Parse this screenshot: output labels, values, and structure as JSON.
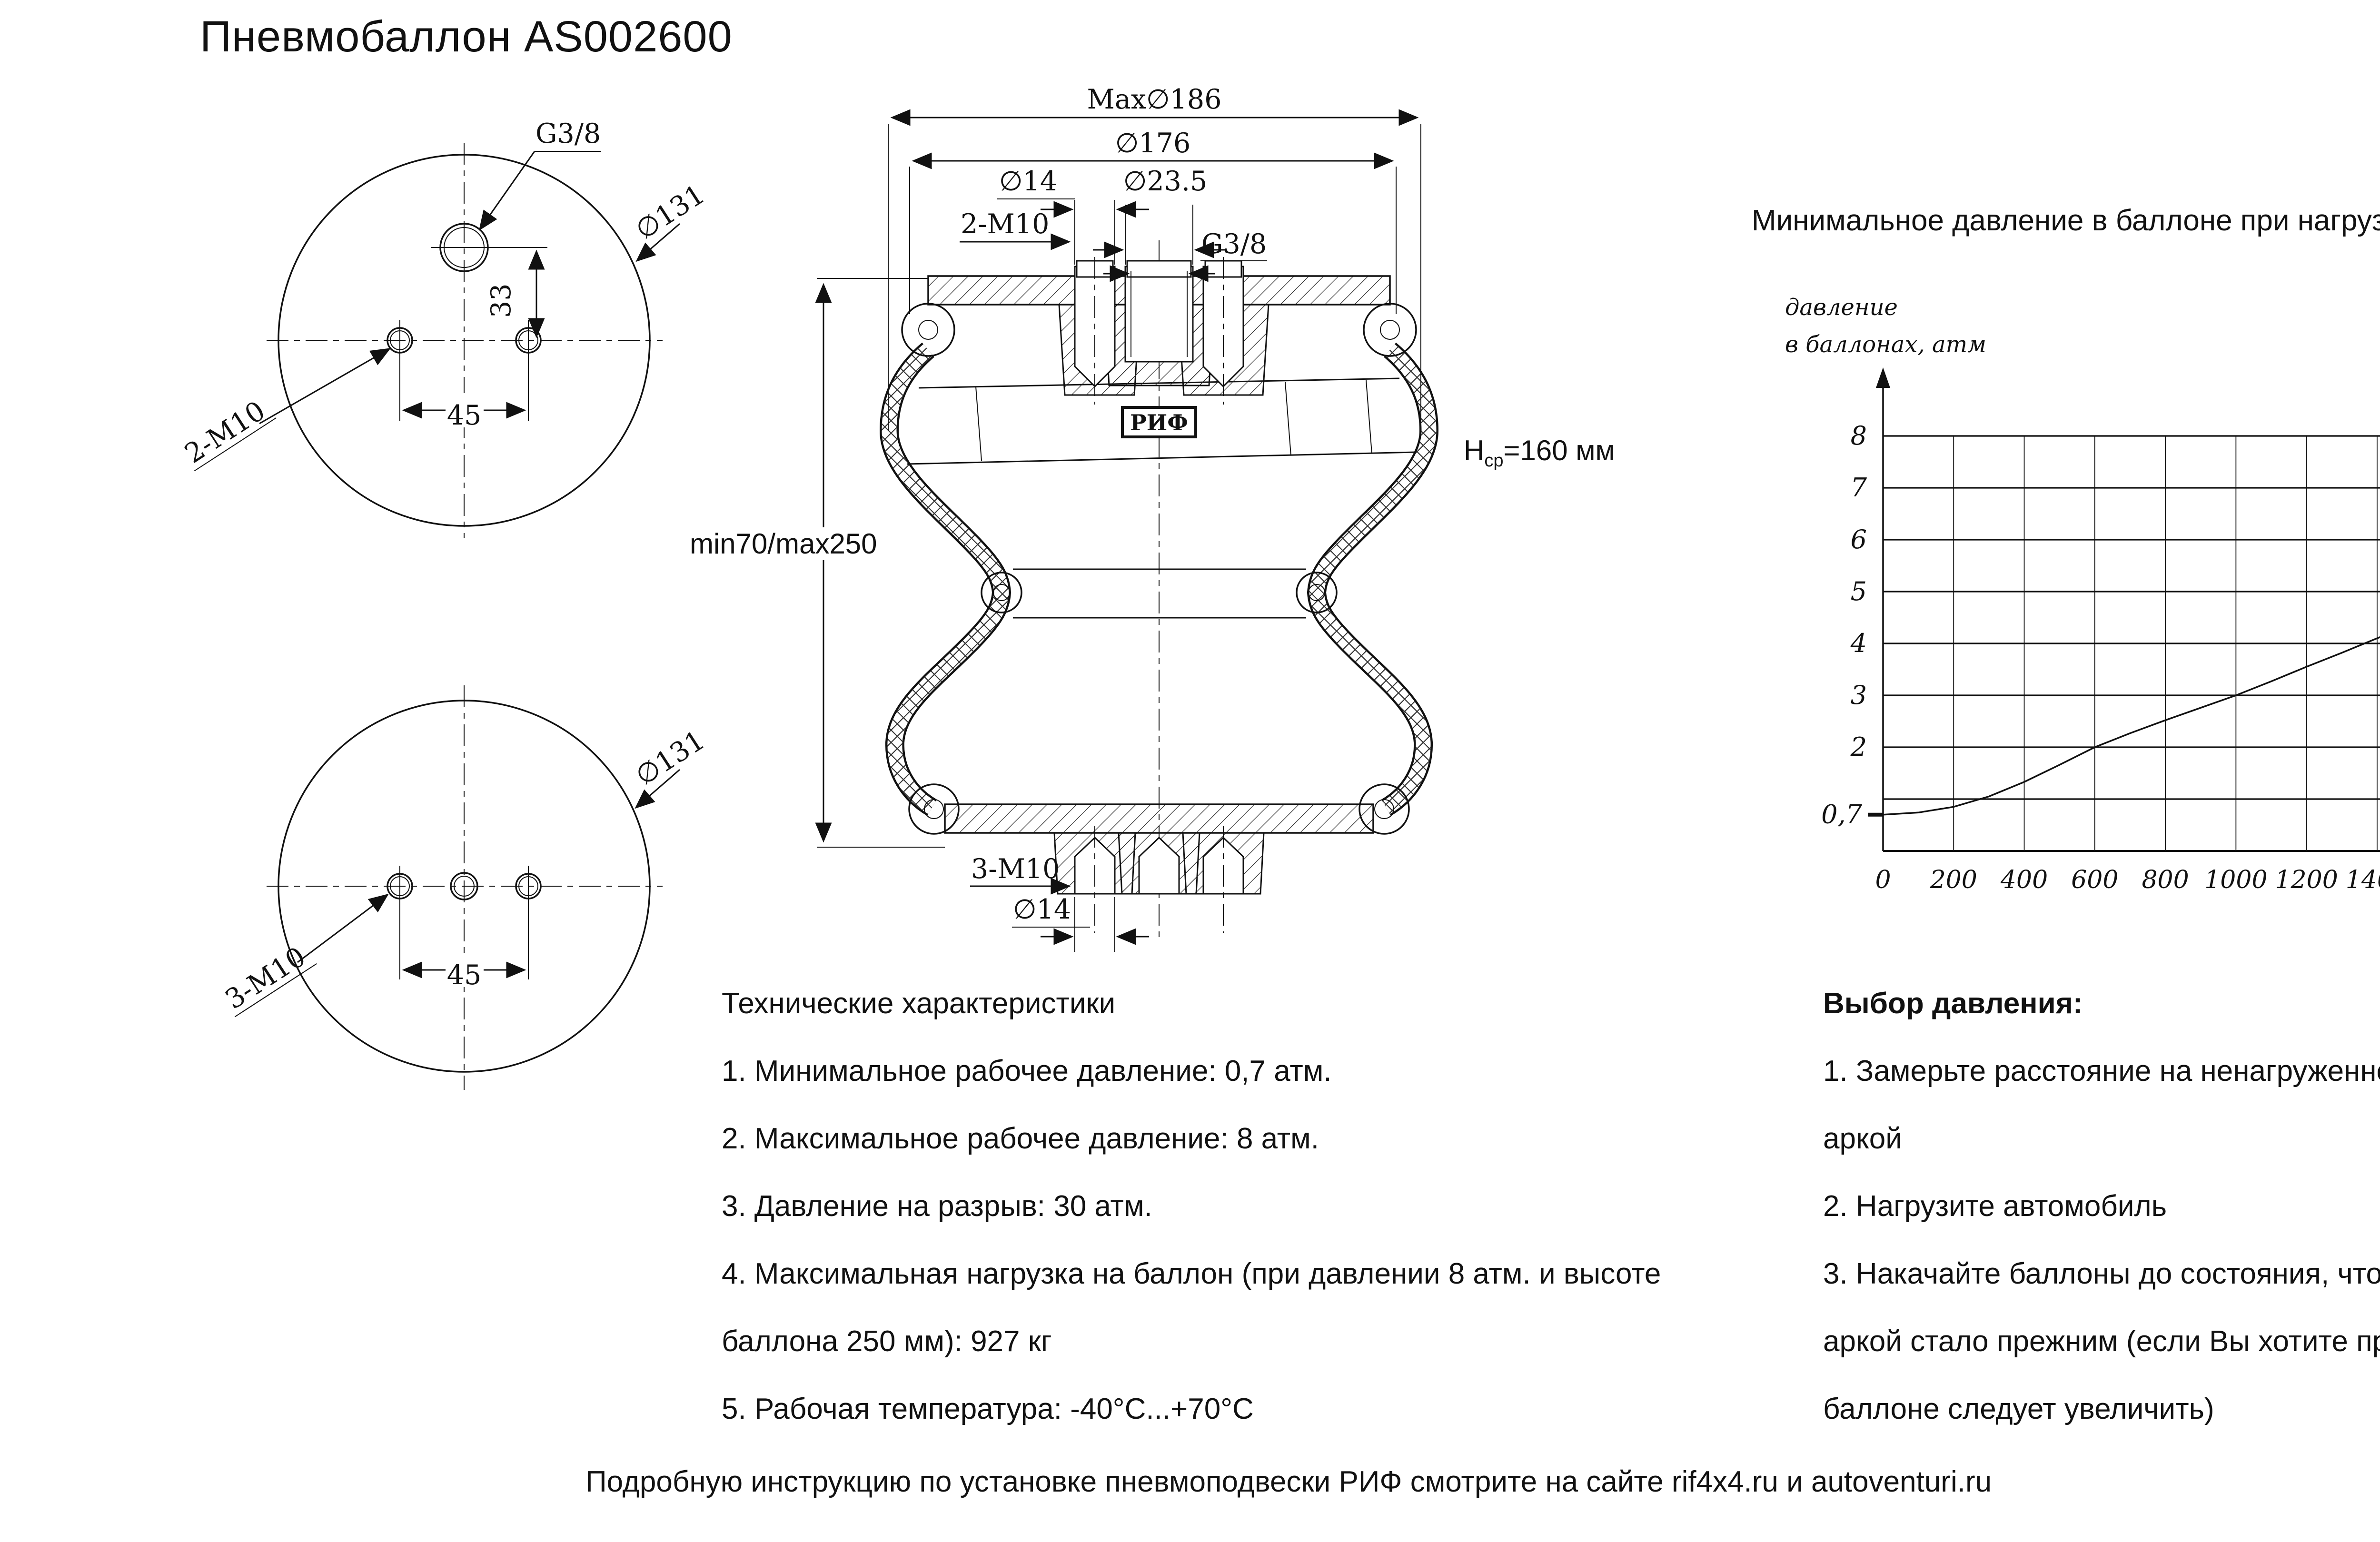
{
  "title": "Пневмобаллон  AS002600",
  "top_view": {
    "g38": "G3/8",
    "d131": "∅131",
    "dim33": "33",
    "dim45": "45",
    "holes_label": "2-M10"
  },
  "bottom_view": {
    "d131": "∅131",
    "dim45": "45",
    "holes_label": "3-M10"
  },
  "section": {
    "max_d": "Max∅186",
    "d176": "∅176",
    "d14_top": "∅14",
    "d235": "∅23.5",
    "m10_top": "2-M10",
    "g38": "G3/8",
    "brand": "РИФ",
    "h_letter": "Н",
    "h_sub": "ср",
    "h_rest": "=160 мм",
    "height_range": "min70/max250",
    "m10_bottom": "3-M10",
    "d14_bottom": "∅14"
  },
  "specs": {
    "title": "Технические характеристики",
    "items": [
      "1. Минимальное рабочее давление: 0,7 атм.",
      "2. Максимальное рабочее давление: 8 атм.",
      "3. Давление на разрыв: 30 атм.",
      "4. Максимальная нагрузка на баллон (при давлении 8 атм. и высоте баллона 250 мм): 927 кг",
      "5. Рабочая температура: -40°C...+70°C"
    ]
  },
  "pressure_selection": {
    "title": "Выбор давления:",
    "items": [
      "1. Замерьте расстояние на ненагруженном автомобиле между центром колеса и аркой",
      "2. Нагрузите автомобиль",
      "3. Накачайте баллоны до состояния, чтобы расстояние между центром колеса и аркой стало прежним (если Вы хотите приподнять автомобиль, давление в баллоне следует увеличить)"
    ]
  },
  "footer": "Подробную инструкцию по установке пневмоподвески РИФ смотрите на сайте rif4x4.ru и autoventuri.ru",
  "chart_data": {
    "type": "line",
    "title": "Минимальное давление в баллоне при нагрузке на заднюю ось автомобиля",
    "ylabel_lines": [
      "давление",
      "в баллонах, атм"
    ],
    "xlabel_lines": [
      "нагрузка на заднюю",
      "ось а/м, кг"
    ],
    "x_ticks": [
      0,
      200,
      400,
      600,
      800,
      1000,
      1200,
      1400,
      1600,
      1800,
      2000
    ],
    "y_ticks": [
      2,
      3,
      4,
      5,
      6,
      7,
      8
    ],
    "y_special": {
      "label": "0,7",
      "value": 0.7
    },
    "grid_x": [
      200,
      400,
      600,
      800,
      1000,
      1200,
      1400,
      1600,
      1800,
      2000,
      2200
    ],
    "grid_y": [
      1,
      2,
      3,
      4,
      5,
      6,
      7,
      8
    ],
    "xlim": [
      0,
      2200
    ],
    "ylim": [
      0,
      8.8
    ],
    "grid": true,
    "legend": "none",
    "series": [
      {
        "name": "Минимальное давление в баллоне",
        "points": [
          [
            0,
            0.7
          ],
          [
            100,
            0.74
          ],
          [
            200,
            0.85
          ],
          [
            300,
            1.05
          ],
          [
            400,
            1.33
          ],
          [
            500,
            1.66
          ],
          [
            600,
            2.0
          ],
          [
            700,
            2.27
          ],
          [
            800,
            2.52
          ],
          [
            900,
            2.76
          ],
          [
            1000,
            3.0
          ],
          [
            1100,
            3.27
          ],
          [
            1200,
            3.55
          ],
          [
            1300,
            3.82
          ],
          [
            1400,
            4.1
          ],
          [
            1500,
            4.36
          ],
          [
            1600,
            4.62
          ],
          [
            1700,
            4.88
          ],
          [
            1800,
            5.14
          ],
          [
            1900,
            5.4
          ],
          [
            2000,
            5.66
          ],
          [
            2100,
            5.93
          ],
          [
            2200,
            6.2
          ]
        ]
      }
    ]
  }
}
